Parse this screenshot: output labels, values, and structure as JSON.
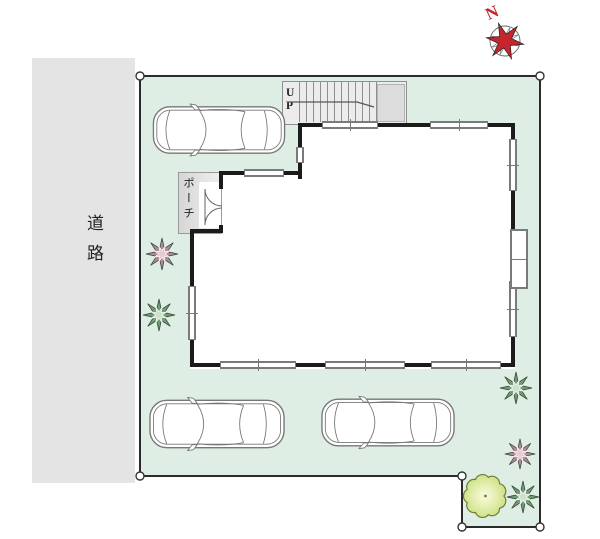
{
  "compass": {
    "label": "N"
  },
  "road": {
    "label": "道路"
  },
  "porch": {
    "label": "ポーチ"
  },
  "stairs": {
    "label_lines": [
      "U",
      "P"
    ]
  },
  "colors": {
    "lot_green": "#deeee4",
    "road_gray": "#e4e4e4",
    "wall_black": "#1b1b1b",
    "boundary": "#2b2b2b",
    "window_line": "#7a7a7a",
    "stairs_bg": "#ececec",
    "stairs_landing": "#dcdcdc",
    "stairs_line": "#8f8f8f",
    "accent_red": "#c5252c",
    "car_line": "#777777",
    "plant_green": "#6f9d72",
    "plant_green_light": "#cfe0cf",
    "plant_mauve": "#b28a98",
    "plant_mauve_light": "#e3cdd5",
    "tree_edge": "#6f7d3a",
    "tree_fill_center": "#f4f8d2",
    "tree_fill_outer": "#cfe287",
    "label_ink": "#222222"
  }
}
